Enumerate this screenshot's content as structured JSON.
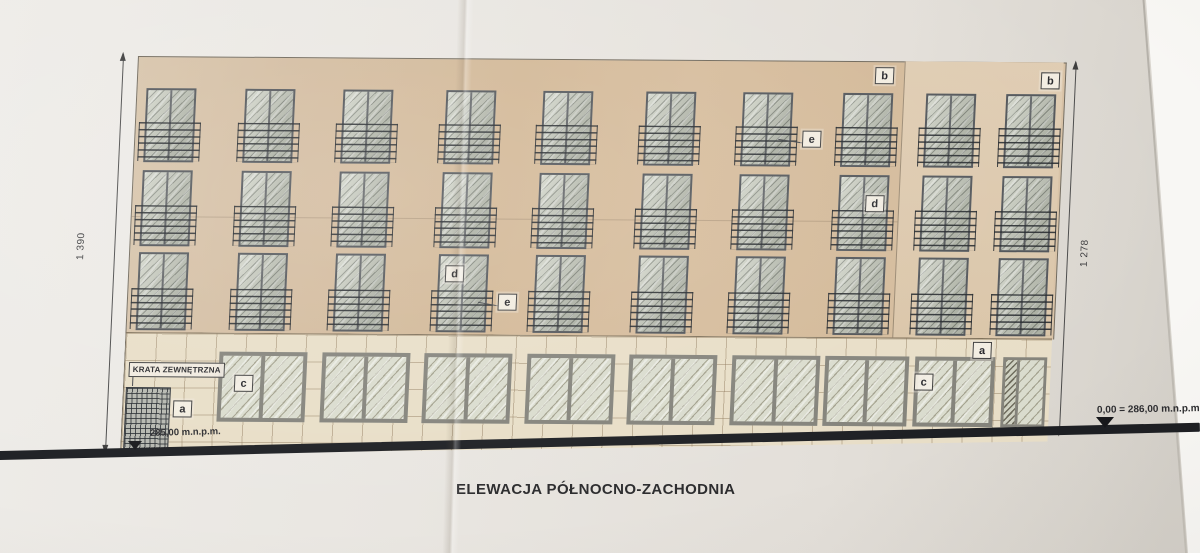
{
  "title": "ELEWACJA PÓŁNOCNO-ZACHODNIA",
  "dimension_labels": {
    "left_total": "1 390",
    "right_total": "1 278"
  },
  "elevation_markers": {
    "ground_left": "285,00 m.n.p.m.",
    "zero_right": "0,00 = 286,00 m.n.p.m."
  },
  "annotations": {
    "grille_label": "KRATA ZEWNĘTRZNA",
    "tags": [
      {
        "label": "b",
        "x": 738,
        "y": 6
      },
      {
        "label": "b",
        "x": 904,
        "y": 10
      },
      {
        "label": "e",
        "x": 668,
        "y": 70
      },
      {
        "label": "d",
        "x": 734,
        "y": 134
      },
      {
        "label": "d",
        "x": 317,
        "y": 207
      },
      {
        "label": "e",
        "x": 371,
        "y": 235
      },
      {
        "label": "a",
        "x": 848,
        "y": 280
      },
      {
        "label": "c",
        "x": 111,
        "y": 318
      },
      {
        "label": "c",
        "x": 791,
        "y": 312
      },
      {
        "label": "a",
        "x": 51,
        "y": 344
      }
    ]
  },
  "facade": {
    "upper_window_rows": 3,
    "upper_window_cols": 10,
    "storefront_windows": 8,
    "entrance_doors": 1
  },
  "colors": {
    "wall": "#d4bb9b",
    "wall_right_section": "#ddc9ae",
    "ground_band": "#e8dec7",
    "glass": "#c9cdc0",
    "terrain_line": "#1d1f23",
    "paper": "#e8e5e0"
  }
}
